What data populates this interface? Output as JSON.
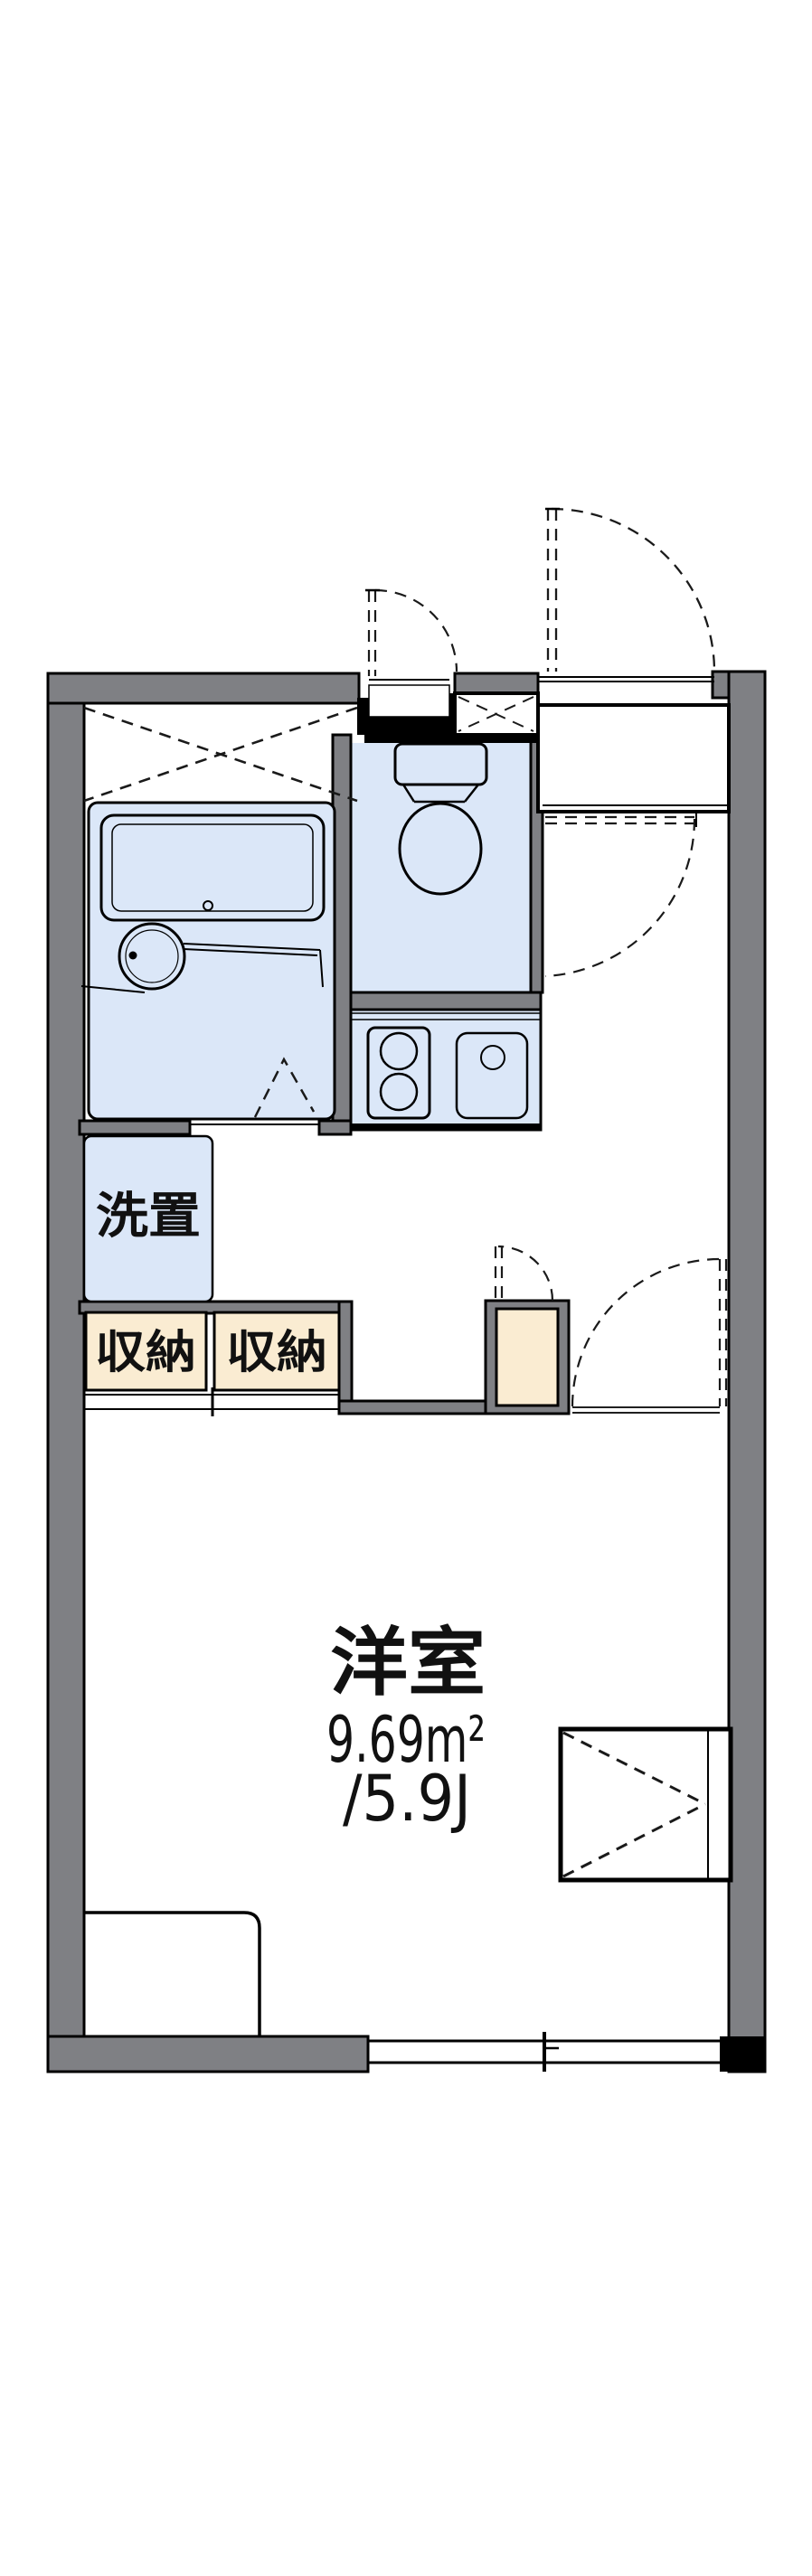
{
  "colors": {
    "background": "#ffffff",
    "wall": "#7f8084",
    "outline": "#000000",
    "dash": "#1a1a1a",
    "fixture": "#dbe7f8",
    "storage": "#faecd2",
    "text": "#111111"
  },
  "plan": {
    "rooms": {
      "western_room": {
        "name": "洋室",
        "area_m2": "9.69m²",
        "area_tatami": "/5.9J"
      },
      "laundry": {
        "label": "洗置"
      },
      "storage_left": {
        "label": "収納"
      },
      "storage_right": {
        "label": "収納"
      }
    }
  }
}
